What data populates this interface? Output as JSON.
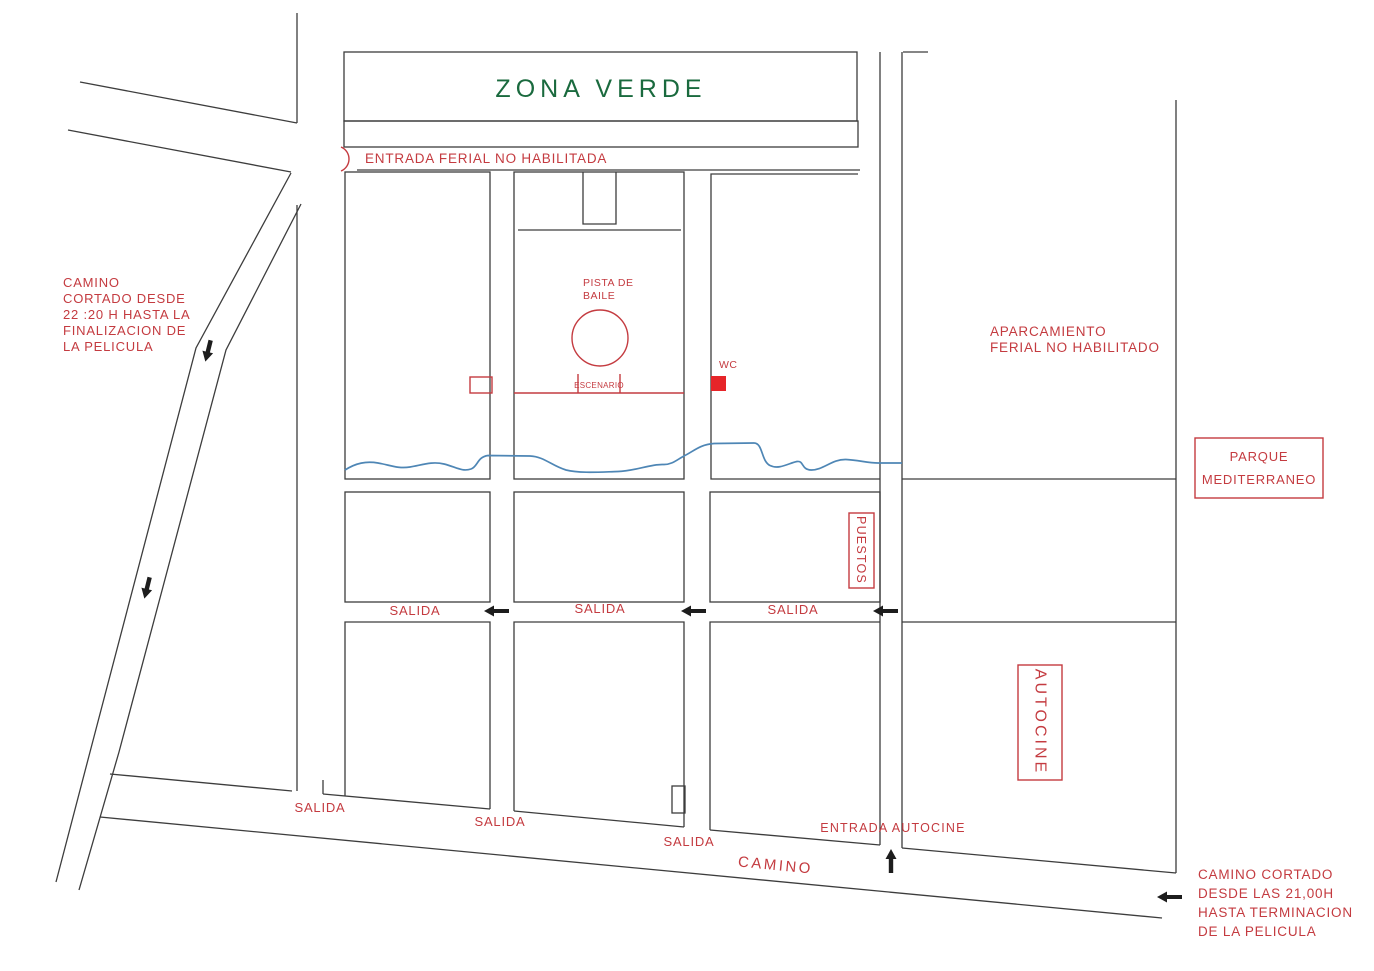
{
  "colors": {
    "line": "#3d3d3d",
    "red": "#c43b40",
    "wc_red": "#e62529",
    "green": "#1a6a3e",
    "blue": "#4e86b5",
    "arrow_black": "#1d1d1d",
    "background": "#ffffff"
  },
  "map": {
    "zona_verde_label": "ZONA VERDE",
    "entrada_ferial_label": "ENTRADA FERIAL NO  HABILITADA",
    "left_closure_note": {
      "lines": [
        "CAMINO",
        "CORTADO DESDE",
        "22 :20 H HASTA LA",
        "FINALIZACION DE",
        "LA PELICULA"
      ]
    },
    "pista_de_baile": {
      "lines": [
        "PISTA DE",
        "BAILE"
      ]
    },
    "escenario_label": "ESCENARIO",
    "wc_label": "WC",
    "aparcamiento": {
      "lines": [
        "APARCAMIENTO",
        "FERIAL NO HABILITADO"
      ]
    },
    "parque_mediterraneo": {
      "lines": [
        "PARQUE",
        "MEDITERRANEO"
      ]
    },
    "puestos_label": "PUESTOS",
    "autocine_label": "AUTOCINE",
    "salidas_mid": [
      "SALIDA",
      "SALIDA",
      "SALIDA"
    ],
    "salidas_bottom": [
      "SALIDA",
      "SALIDA",
      "SALIDA"
    ],
    "entrada_autocine_label": "ENTRADA AUTOCINE",
    "camino_label": "CAMINO",
    "right_closure_note": {
      "lines": [
        "CAMINO CORTADO",
        "DESDE LAS 21,00H",
        "HASTA TERMINACION",
        "DE LA PELICULA"
      ]
    }
  }
}
